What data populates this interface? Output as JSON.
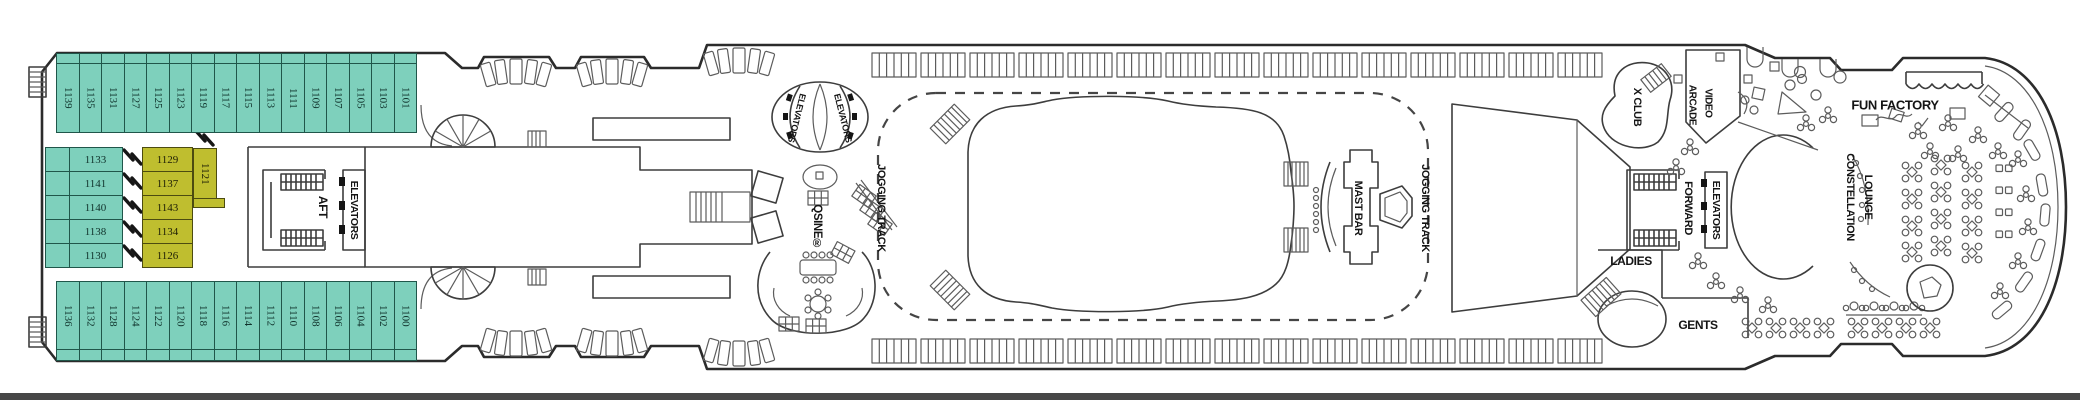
{
  "deck_plan": {
    "colors": {
      "cabin_teal": "#7ED0BC",
      "cabin_yellow": "#BFBE2F",
      "outline": "#2B2B2B"
    },
    "labels": {
      "aft": "AFT",
      "aft_elevators": "ELEVATORS",
      "mid_elevators_left": "ELEVATORS",
      "mid_elevators_right": "ELEVATORS",
      "qsine": "QSINE®",
      "jogging_track_left": "JOGGING TRACK",
      "jogging_track_right": "JOGGING TRACK",
      "mast_bar": "MAST BAR",
      "x_club": "X CLUB",
      "video": "VIDEO",
      "arcade": "ARCADE",
      "fun_factory": "FUN FACTORY",
      "constellation": "CONSTELLATION",
      "lounge": "LOUNGE",
      "forward": "FORWARD",
      "forward_elevators": "ELEVATORS",
      "ladies": "LADIES",
      "gents": "GENTS"
    },
    "cabins": {
      "top_row": [
        "1139",
        "1135",
        "1131",
        "1127",
        "1125",
        "1123",
        "1119",
        "1117",
        "1115",
        "1113",
        "1111",
        "1109",
        "1107",
        "1105",
        "1103",
        "1101"
      ],
      "bottom_row": [
        "1136",
        "1132",
        "1128",
        "1124",
        "1122",
        "1120",
        "1118",
        "1116",
        "1114",
        "1112",
        "1110",
        "1108",
        "1106",
        "1104",
        "1102",
        "1100"
      ],
      "mid_port": [
        "1133",
        "1141",
        "1140",
        "1138",
        "1130"
      ],
      "mid_inside": [
        "1129",
        "1137",
        "1143",
        "1134",
        "1126"
      ],
      "inside_tall": "1121"
    }
  }
}
